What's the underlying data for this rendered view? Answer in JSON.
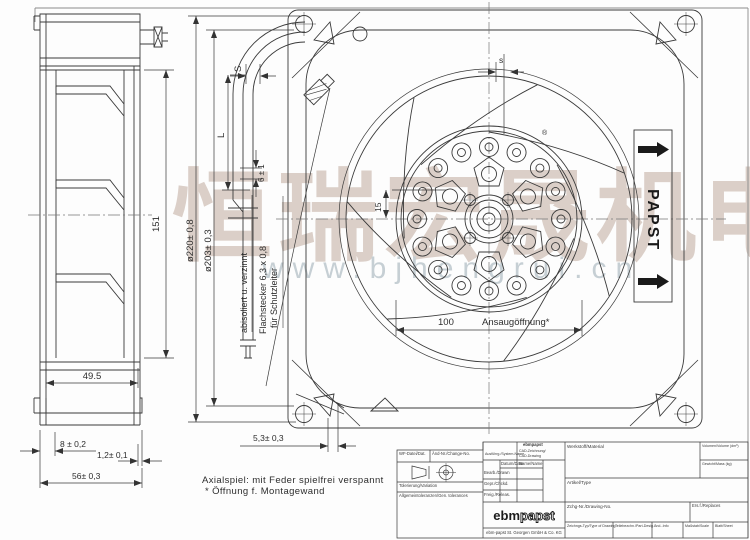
{
  "watermark": {
    "cn_text": "恒瑞宏晟机电",
    "url_text": "www.bjhengrui.cn"
  },
  "side_view": {
    "dim_height": "151",
    "dim_width": "49.5",
    "dim_flange": "8 ± 0,2",
    "dim_lip": "1,2± 0,1",
    "dim_depth": "56± 0,3"
  },
  "cable_detail": {
    "dim_s": "S",
    "dim_l": "L",
    "dim_strip": "6 ± 1",
    "wire_label": "abisoliert u. verzinnt",
    "connector_label_1": "Flachstecker 6,3 x 0,8",
    "connector_label_2": "für Schutzleiter"
  },
  "front_view": {
    "dim_dia_outer": "ø220± 0,8",
    "dim_dia_inner": "ø203± 0,3",
    "dim_gap": "s",
    "dim_hub_offset": "15",
    "dim_opening_value": "100",
    "dim_opening_label": "Ansaugöffnung*",
    "dim_foot": "5,3± 0,3",
    "registered_mark": "®",
    "brand_label": "PAPST"
  },
  "notes": {
    "line1": "Axialspiel: mit Feder spielfrei verspannt",
    "line2": "* Öffnung f. Montagewand"
  },
  "title_block": {
    "wf_file": "WF-Datei/Dat.",
    "change_no": "Änd-Nr./Change-No.",
    "system_name": "Ausführg./System-Name",
    "brand_small": "ebmpapst",
    "cad_line1": "CAD-Zeichnung/",
    "cad_line2": "CAD-Drawing",
    "date_header": "Datum/Date",
    "name_header": "Name/Name",
    "row_drawn": "Bearb./Drawn",
    "row_checked": "Gepr./Chckd.",
    "row_released": "Freig./Releas.",
    "material": "Werkstoff/Material",
    "volume": "Volumen/Volume (dm³)",
    "mass": "Gewicht/Mass (kg)",
    "article": "Artikel/Type",
    "tolerance": "Tolerierung/Variation",
    "general_tolerance": "Allgemeintoleranzen/Gen. tolerances",
    "drawing_no": "Zchg-Nr./Drawing-No.",
    "replaces": "Ers.f./Replaces",
    "cell_type": "Zeichngs-Typ/Type of Drawing",
    "cell_part": "Teilebezchn./Part-Desig.",
    "cell_change": "Änd.-Info",
    "cell_scale": "Maßstab/Scale",
    "cell_sheet": "Blatt/Sheet",
    "logo_ebm": "ebm",
    "logo_papst": "papst",
    "company": "ebm-papst St. Georgen GmbH & Co. KG"
  }
}
